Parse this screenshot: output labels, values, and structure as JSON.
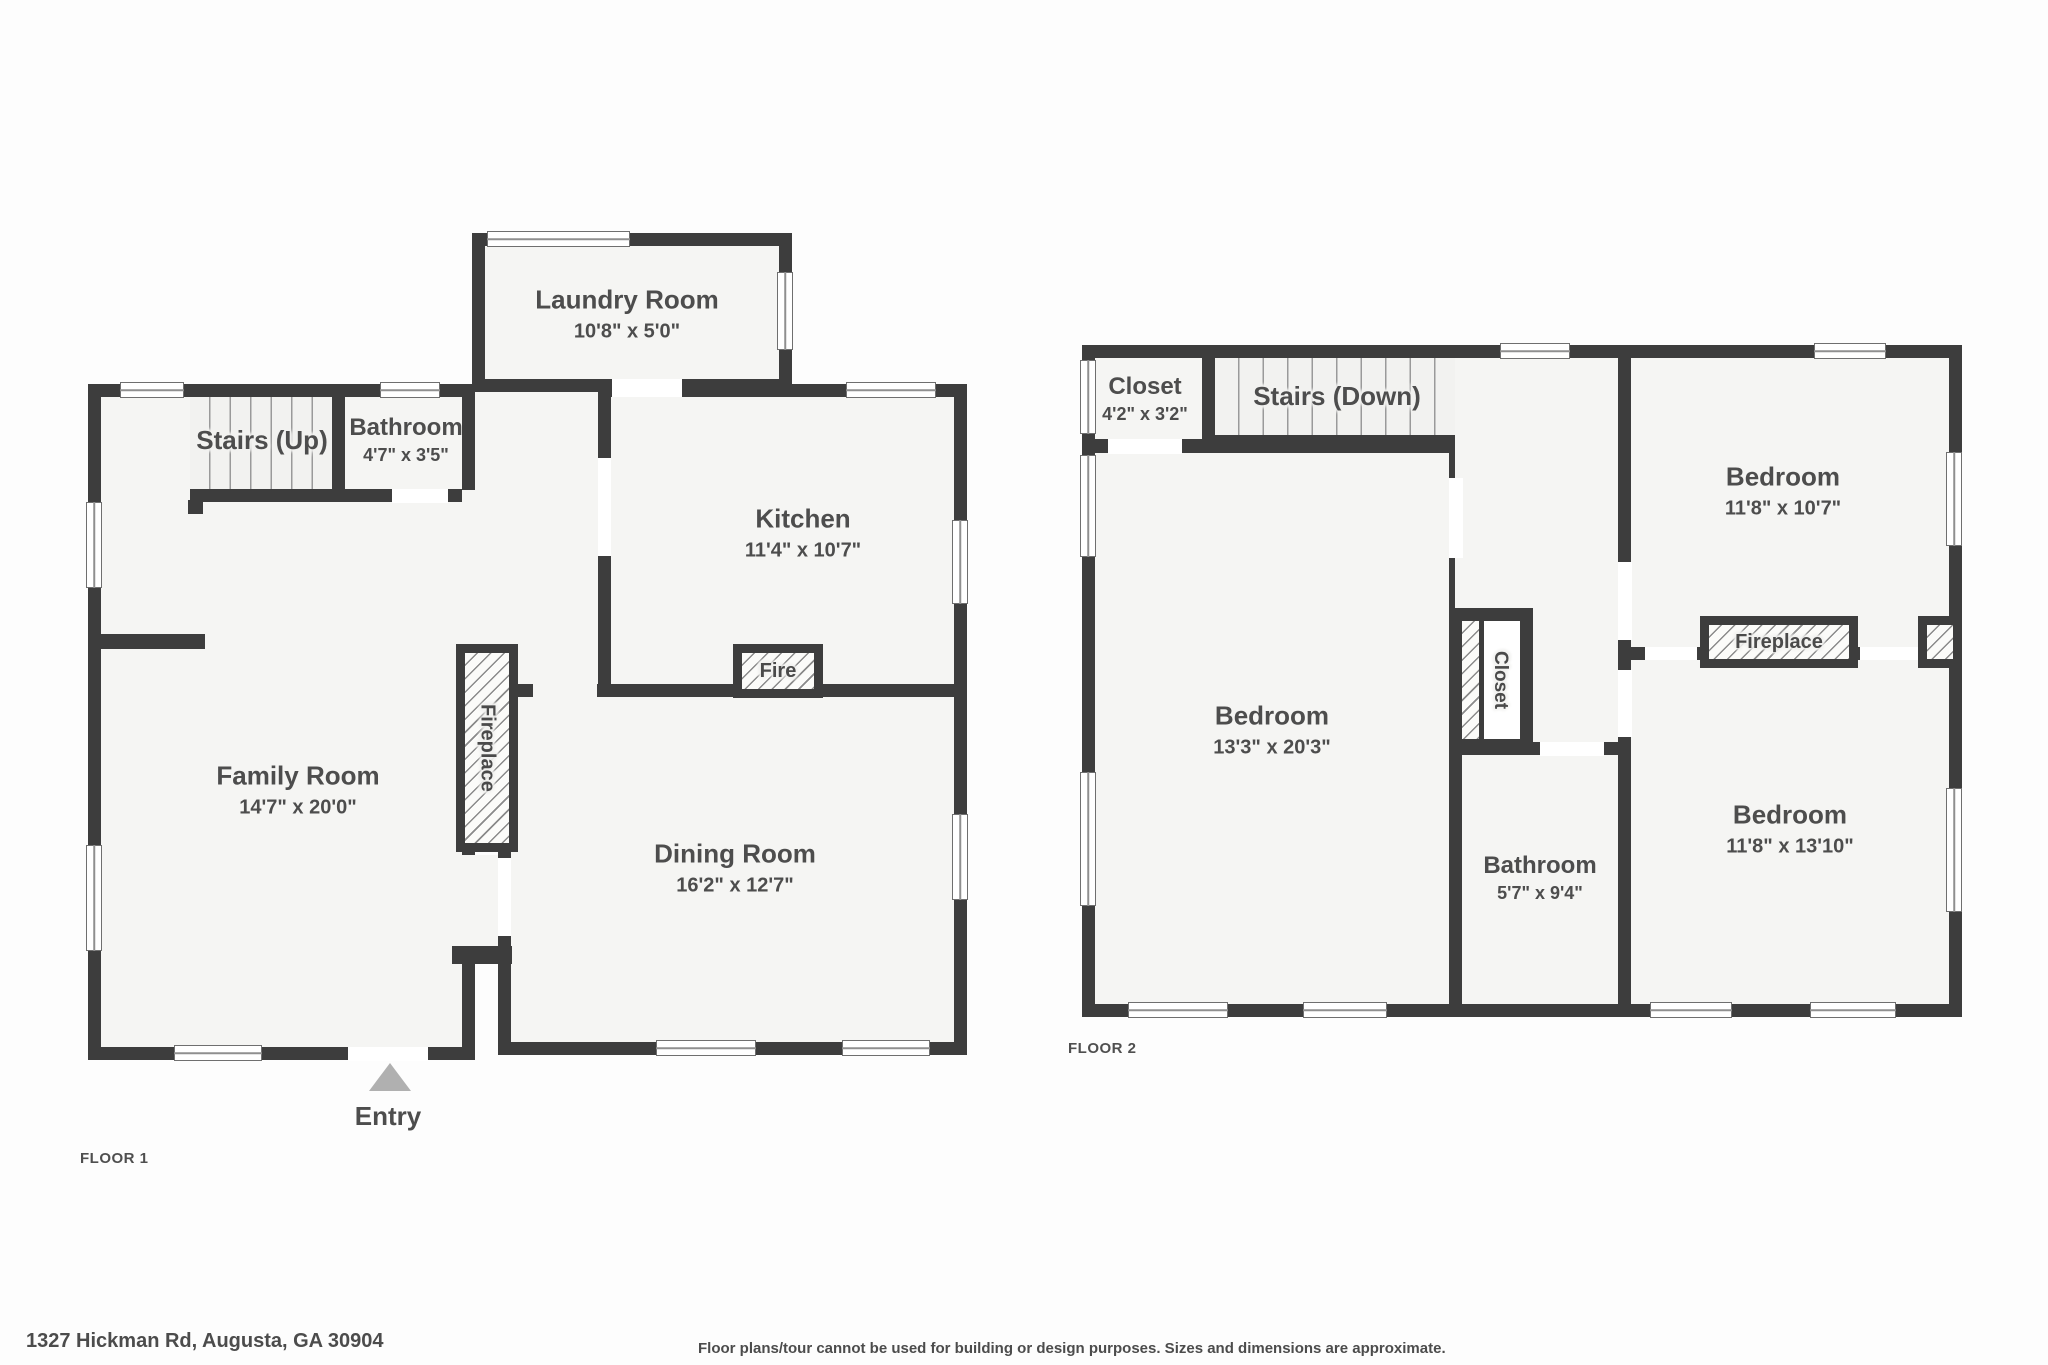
{
  "meta": {
    "wall_color": "#3d3d3d",
    "floor_color": "#f5f5f3",
    "background_color": "#fdfdfd",
    "text_color": "#4d4d4d",
    "entry_arrow_color": "#b0b0b0"
  },
  "floor1": {
    "label": "FLOOR 1",
    "entry_label": "Entry",
    "rooms": {
      "laundry": {
        "name": "Laundry Room",
        "dims": "10'8\" x 5'0\""
      },
      "stairs": {
        "name": "Stairs (Up)"
      },
      "bathroom": {
        "name": "Bathroom",
        "dims": "4'7\" x 3'5\""
      },
      "kitchen": {
        "name": "Kitchen",
        "dims": "11'4\" x 10'7\""
      },
      "family": {
        "name": "Family Room",
        "dims": "14'7\" x 20'0\""
      },
      "dining": {
        "name": "Dining Room",
        "dims": "16'2\" x 12'7\""
      },
      "fire": {
        "name": "Fire"
      },
      "fireplace": {
        "name": "Fireplace"
      }
    }
  },
  "floor2": {
    "label": "FLOOR 2",
    "rooms": {
      "closet_top": {
        "name": "Closet",
        "dims": "4'2\" x 3'2\""
      },
      "stairs": {
        "name": "Stairs (Down)"
      },
      "bedroom_left": {
        "name": "Bedroom",
        "dims": "13'3\" x 20'3\""
      },
      "bedroom_top": {
        "name": "Bedroom",
        "dims": "11'8\" x 10'7\""
      },
      "bedroom_bottom": {
        "name": "Bedroom",
        "dims": "11'8\" x 13'10\""
      },
      "closet_mid": {
        "name": "Closet"
      },
      "bathroom": {
        "name": "Bathroom",
        "dims": "5'7\" x 9'4\""
      },
      "fireplace": {
        "name": "Fireplace"
      }
    }
  },
  "footer": {
    "address": "1327 Hickman Rd, Augusta, GA 30904",
    "disclaimer": "Floor plans/tour cannot be used for building or design purposes. Sizes and dimensions are approximate."
  }
}
